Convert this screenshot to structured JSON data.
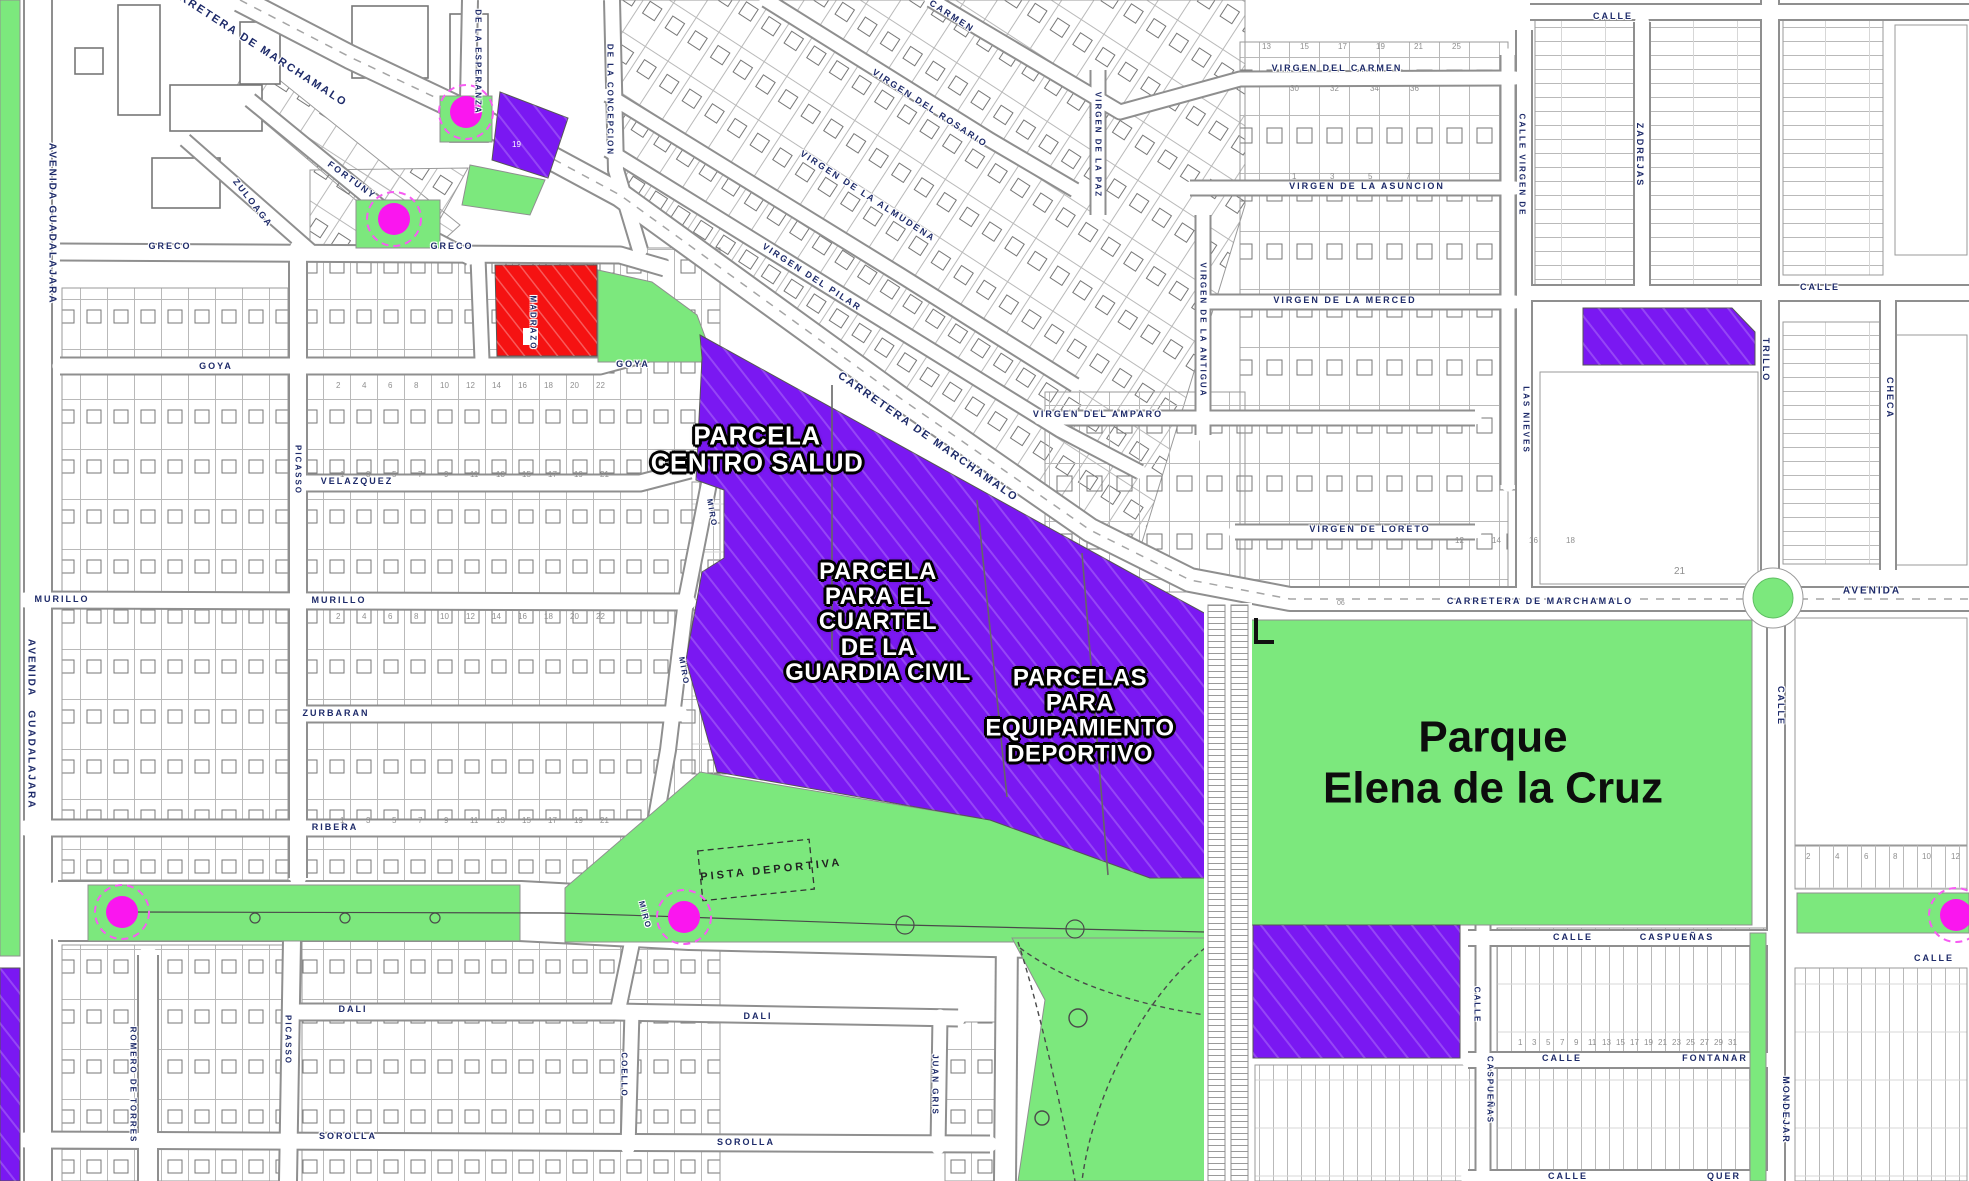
{
  "colors": {
    "purple": "#7A18F2",
    "green": "#7CE87D",
    "red": "#F51212",
    "magenta": "#FA16EF",
    "magenta_ring": "#F75CF2",
    "street_label": "#1d2a69",
    "road_casing": "#8f8f8f",
    "parcel_line": "#b9b9b9",
    "building_line": "#777777"
  },
  "park": {
    "name": "Parque\nElena de la Cruz"
  },
  "zones": [
    {
      "id": "centro-salud",
      "label": "PARCELA\nCENTRO SALUD",
      "cx": 757,
      "cy": 450,
      "size": 26
    },
    {
      "id": "cuartel",
      "label": "PARCELA\nPARA EL\nCUARTEL\nDE LA\nGUARDIA CIVIL",
      "cx": 878,
      "cy": 622,
      "size": 24
    },
    {
      "id": "equipamiento",
      "label": "PARCELAS\nPARA\nEQUIPAMIENTO\nDEPORTIVO",
      "cx": 1080,
      "cy": 716,
      "size": 24
    }
  ],
  "pista_label": "PISTA DEPORTIVA",
  "street_labels": [
    {
      "t": "AVENIDA",
      "x": 52,
      "y": 172,
      "r": 90
    },
    {
      "t": "GUADALAJARA",
      "x": 52,
      "y": 255,
      "r": 90
    },
    {
      "t": "AVENIDA",
      "x": 31,
      "y": 668,
      "r": 90
    },
    {
      "t": "GUADALAJARA",
      "x": 31,
      "y": 760,
      "r": 90
    },
    {
      "t": "CARRETERA DE MARCHAMALO",
      "x": 255,
      "y": 45,
      "r": 33,
      "s": 11
    },
    {
      "t": "CARRETERA DE MARCHAMALO",
      "x": 928,
      "y": 437,
      "r": 35,
      "s": 11
    },
    {
      "t": "CARRETERA DE MARCHAMALO",
      "x": 1540,
      "y": 601,
      "r": 0,
      "s": 9
    },
    {
      "t": "AVENIDA",
      "x": 1872,
      "y": 591,
      "r": 0,
      "s": 10
    },
    {
      "t": "DE LA ESPERANZA",
      "x": 478,
      "y": 62,
      "r": 90,
      "s": 8
    },
    {
      "t": "DE LA CONCEPCION",
      "x": 610,
      "y": 100,
      "r": 90,
      "s": 8
    },
    {
      "t": "FORTUNY",
      "x": 352,
      "y": 180,
      "r": 36,
      "s": 9
    },
    {
      "t": "ZULOAGA",
      "x": 253,
      "y": 203,
      "r": 52,
      "s": 9
    },
    {
      "t": "GRECO",
      "x": 170,
      "y": 246,
      "r": 0,
      "s": 9
    },
    {
      "t": "GRECO",
      "x": 452,
      "y": 246,
      "r": 0,
      "s": 9
    },
    {
      "t": "MADRAZO",
      "x": 533,
      "y": 323,
      "r": 90,
      "s": 8
    },
    {
      "t": "GOYA",
      "x": 216,
      "y": 366,
      "r": 0,
      "s": 9
    },
    {
      "t": "GOYA",
      "x": 633,
      "y": 364,
      "r": 0,
      "s": 9
    },
    {
      "t": "VELAZQUEZ",
      "x": 357,
      "y": 481,
      "r": 0,
      "s": 9
    },
    {
      "t": "MURILLO",
      "x": 62,
      "y": 599,
      "r": 0,
      "s": 9
    },
    {
      "t": "MURILLO",
      "x": 339,
      "y": 600,
      "r": 0,
      "s": 9
    },
    {
      "t": "ZURBARAN",
      "x": 336,
      "y": 713,
      "r": 0,
      "s": 9
    },
    {
      "t": "RIBERA",
      "x": 335,
      "y": 827,
      "r": 0,
      "s": 9
    },
    {
      "t": "DALI",
      "x": 353,
      "y": 1009,
      "r": 0,
      "s": 9
    },
    {
      "t": "DALI",
      "x": 758,
      "y": 1016,
      "r": 0,
      "s": 9
    },
    {
      "t": "SOROLLA",
      "x": 348,
      "y": 1136,
      "r": 0,
      "s": 9
    },
    {
      "t": "SOROLLA",
      "x": 746,
      "y": 1142,
      "r": 0,
      "s": 9
    },
    {
      "t": "PICASSO",
      "x": 298,
      "y": 470,
      "r": 90,
      "s": 8
    },
    {
      "t": "PICASSO",
      "x": 288,
      "y": 1040,
      "r": 90,
      "s": 8
    },
    {
      "t": "ROMERO DE TORRES",
      "x": 133,
      "y": 1085,
      "r": 90,
      "s": 8
    },
    {
      "t": "MIRO",
      "x": 712,
      "y": 513,
      "r": 80,
      "s": 8
    },
    {
      "t": "MIRO",
      "x": 684,
      "y": 671,
      "r": 80,
      "s": 8
    },
    {
      "t": "MIRO",
      "x": 645,
      "y": 915,
      "r": 75,
      "s": 8
    },
    {
      "t": "COELLO",
      "x": 624,
      "y": 1075,
      "r": 90,
      "s": 8
    },
    {
      "t": "JUAN GRIS",
      "x": 935,
      "y": 1085,
      "r": 90,
      "s": 8
    },
    {
      "t": "CARMEN",
      "x": 952,
      "y": 16,
      "r": 33,
      "s": 9
    },
    {
      "t": "VIRGEN DEL ROSARIO",
      "x": 930,
      "y": 108,
      "r": 33,
      "s": 9
    },
    {
      "t": "VIRGEN DE LA ALMUDENA",
      "x": 868,
      "y": 196,
      "r": 33,
      "s": 9
    },
    {
      "t": "VIRGEN DEL PILAR",
      "x": 812,
      "y": 277,
      "r": 33,
      "s": 9
    },
    {
      "t": "VIRGEN DEL CARMEN",
      "x": 1337,
      "y": 68,
      "r": 0,
      "s": 9
    },
    {
      "t": "VIRGEN DE LA ASUNCION",
      "x": 1367,
      "y": 186,
      "r": 0,
      "s": 9
    },
    {
      "t": "VIRGEN DE LA MERCED",
      "x": 1345,
      "y": 300,
      "r": 0,
      "s": 9
    },
    {
      "t": "VIRGEN DEL AMPARO",
      "x": 1098,
      "y": 414,
      "r": 0,
      "s": 9
    },
    {
      "t": "VIRGEN DE LORETO",
      "x": 1370,
      "y": 529,
      "r": 0,
      "s": 9
    },
    {
      "t": "VIRGEN DE LA PAZ",
      "x": 1098,
      "y": 145,
      "r": 90,
      "s": 8
    },
    {
      "t": "VIRGEN DE LA ANTIGUA",
      "x": 1203,
      "y": 330,
      "r": 90,
      "s": 8
    },
    {
      "t": "CALLE",
      "x": 1613,
      "y": 16,
      "r": 0,
      "s": 9
    },
    {
      "t": "ZADREJAS",
      "x": 1640,
      "y": 155,
      "r": 90,
      "s": 9
    },
    {
      "t": "CALLE",
      "x": 1820,
      "y": 287,
      "r": 0,
      "s": 9
    },
    {
      "t": "CALLE VIRGEN DE",
      "x": 1522,
      "y": 165,
      "r": 90,
      "s": 8
    },
    {
      "t": "LAS NIEVES",
      "x": 1526,
      "y": 420,
      "r": 90,
      "s": 8
    },
    {
      "t": "TRILLO",
      "x": 1766,
      "y": 360,
      "r": 90,
      "s": 9
    },
    {
      "t": "CHECA",
      "x": 1890,
      "y": 398,
      "r": 90,
      "s": 9
    },
    {
      "t": "CALLE",
      "x": 1781,
      "y": 706,
      "r": 90,
      "s": 9
    },
    {
      "t": "MONDEJAR",
      "x": 1786,
      "y": 1110,
      "r": 90,
      "s": 9
    },
    {
      "t": "CALLE",
      "x": 1573,
      "y": 937,
      "r": 0,
      "s": 9
    },
    {
      "t": "CASPUEÑAS",
      "x": 1677,
      "y": 937,
      "r": 0,
      "s": 9
    },
    {
      "t": "CALLE",
      "x": 1562,
      "y": 1058,
      "r": 0,
      "s": 9
    },
    {
      "t": "FONTANAR",
      "x": 1715,
      "y": 1058,
      "r": 0,
      "s": 9
    },
    {
      "t": "CALLE",
      "x": 1568,
      "y": 1176,
      "r": 0,
      "s": 9
    },
    {
      "t": "QUER",
      "x": 1724,
      "y": 1176,
      "r": 0,
      "s": 9
    },
    {
      "t": "CALLE",
      "x": 1477,
      "y": 1005,
      "r": 90,
      "s": 8
    },
    {
      "t": "CASPUEÑAS",
      "x": 1490,
      "y": 1090,
      "r": 90,
      "s": 8
    },
    {
      "t": "CALLE",
      "x": 1934,
      "y": 958,
      "r": 0,
      "s": 9
    }
  ],
  "number_rows": [
    {
      "nums": [
        "2",
        "4",
        "6",
        "8",
        "10",
        "12",
        "14",
        "16",
        "18",
        "20",
        "22"
      ],
      "x0": 336,
      "y": 381,
      "dx": 26
    },
    {
      "nums": [
        "1",
        "3",
        "5",
        "7",
        "9",
        "11",
        "13",
        "15",
        "17",
        "19",
        "21"
      ],
      "x0": 340,
      "y": 470,
      "dx": 26
    },
    {
      "nums": [
        "2",
        "4",
        "6",
        "8",
        "10",
        "12",
        "14",
        "16",
        "18",
        "20",
        "22"
      ],
      "x0": 336,
      "y": 612,
      "dx": 26
    },
    {
      "nums": [
        "1",
        "3",
        "5",
        "7",
        "9",
        "11",
        "13",
        "15",
        "17",
        "19",
        "21"
      ],
      "x0": 340,
      "y": 816,
      "dx": 26
    },
    {
      "nums": [
        "13",
        "15",
        "17",
        "19",
        "21",
        "25"
      ],
      "x0": 1262,
      "y": 42,
      "dx": 38
    },
    {
      "nums": [
        "30",
        "32",
        "34",
        "36"
      ],
      "x0": 1290,
      "y": 84,
      "dx": 40
    },
    {
      "nums": [
        "1",
        "3",
        "5",
        "7"
      ],
      "x0": 1292,
      "y": 172,
      "dx": 38
    },
    {
      "nums": [
        "12",
        "14",
        "16",
        "18"
      ],
      "x0": 1455,
      "y": 536,
      "dx": 37
    },
    {
      "nums": [
        "2",
        "4",
        "6",
        "8",
        "10",
        "12"
      ],
      "x0": 1806,
      "y": 852,
      "dx": 29
    },
    {
      "nums": [
        "1",
        "3",
        "5",
        "7",
        "9",
        "11",
        "13",
        "15",
        "17",
        "19",
        "21",
        "23",
        "25",
        "27",
        "29",
        "31"
      ],
      "x0": 1518,
      "y": 1038,
      "dx": 14
    }
  ],
  "single_numbers": [
    {
      "t": "21",
      "x": 1674,
      "y": 566,
      "s": 10,
      "c": "#8f8f8f"
    },
    {
      "t": "19",
      "x": 512,
      "y": 140,
      "s": 8,
      "c": "#ffffff"
    },
    {
      "t": "06",
      "x": 1337,
      "y": 600,
      "s": 7,
      "c": "#8f8f8f"
    }
  ],
  "roundabouts_magenta": [
    {
      "id": "glorieta-esperanza",
      "x": 466,
      "y": 112
    },
    {
      "id": "glorieta-fortuny",
      "x": 394,
      "y": 219
    },
    {
      "id": "glorieta-ribera-oeste",
      "x": 122,
      "y": 912
    },
    {
      "id": "glorieta-miro",
      "x": 684,
      "y": 917
    },
    {
      "id": "glorieta-este",
      "x": 1956,
      "y": 915
    }
  ]
}
